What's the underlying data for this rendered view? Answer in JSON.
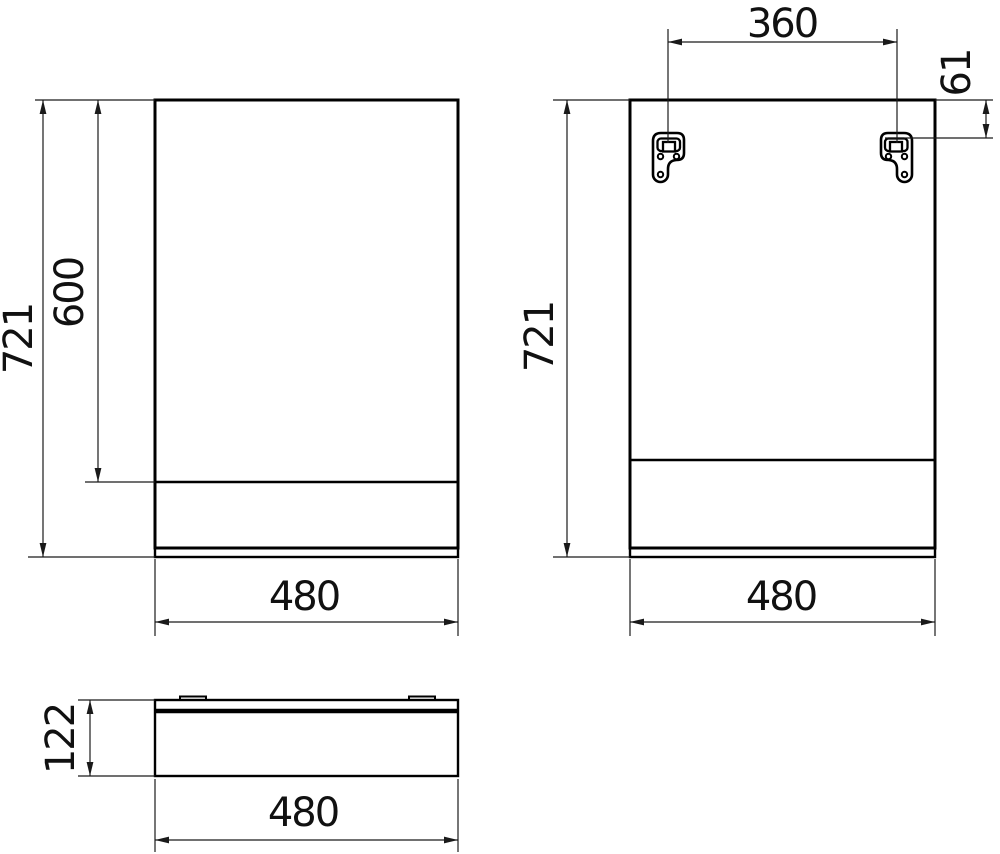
{
  "drawing": {
    "front_view": {
      "total_height": "721",
      "door_height": "600",
      "width": "480"
    },
    "back_view": {
      "total_height": "721",
      "bracket_spacing": "360",
      "bracket_offset": "61",
      "width": "480"
    },
    "top_view": {
      "depth": "122",
      "width": "480"
    },
    "colors": {
      "line": "#000000",
      "dimension": "#1a1a1a",
      "background": "#ffffff"
    }
  }
}
